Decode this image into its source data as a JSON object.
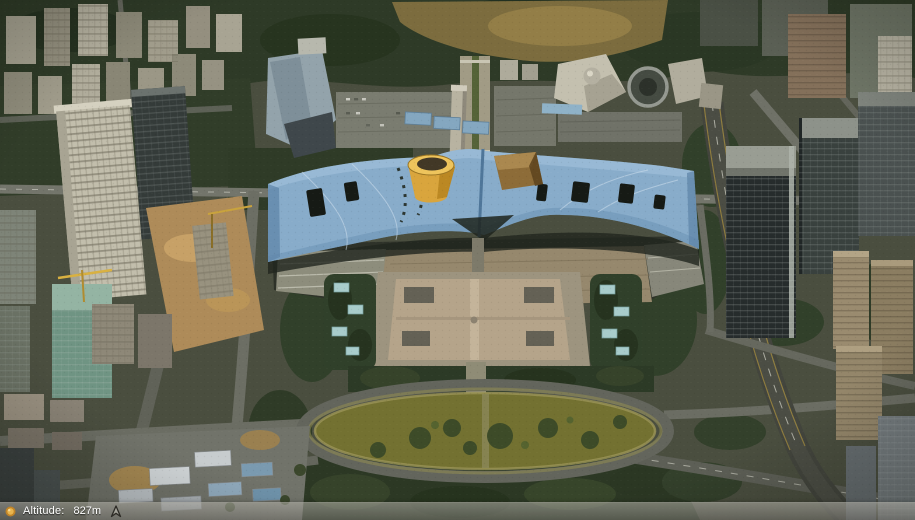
{
  "status_bar": {
    "streaming_icon": "streaming-status-icon",
    "altitude_label": "Altitude:",
    "altitude_value": "827m",
    "north_arrow_icon": "north-arrow-icon",
    "colors": {
      "bar_background": "#8c8a84",
      "text": "#ffffff",
      "streaming_icon_orange": "#e2a83e",
      "north_arrow_dark": "#2d2b26"
    }
  },
  "scene_palette": {
    "civic_center_roof_blue": "#88acca",
    "roof_funnel_yellow": "#d9a53d",
    "roof_dome_brown": "#8d6c38",
    "civic_plaza_tan": "#b5a48a",
    "oval_park_grass_olive": "#737131",
    "vegetation_dark_green": "#2e3a27",
    "road_gray": "#6c6e64",
    "construction_dirt_tan": "#ae8b59"
  }
}
